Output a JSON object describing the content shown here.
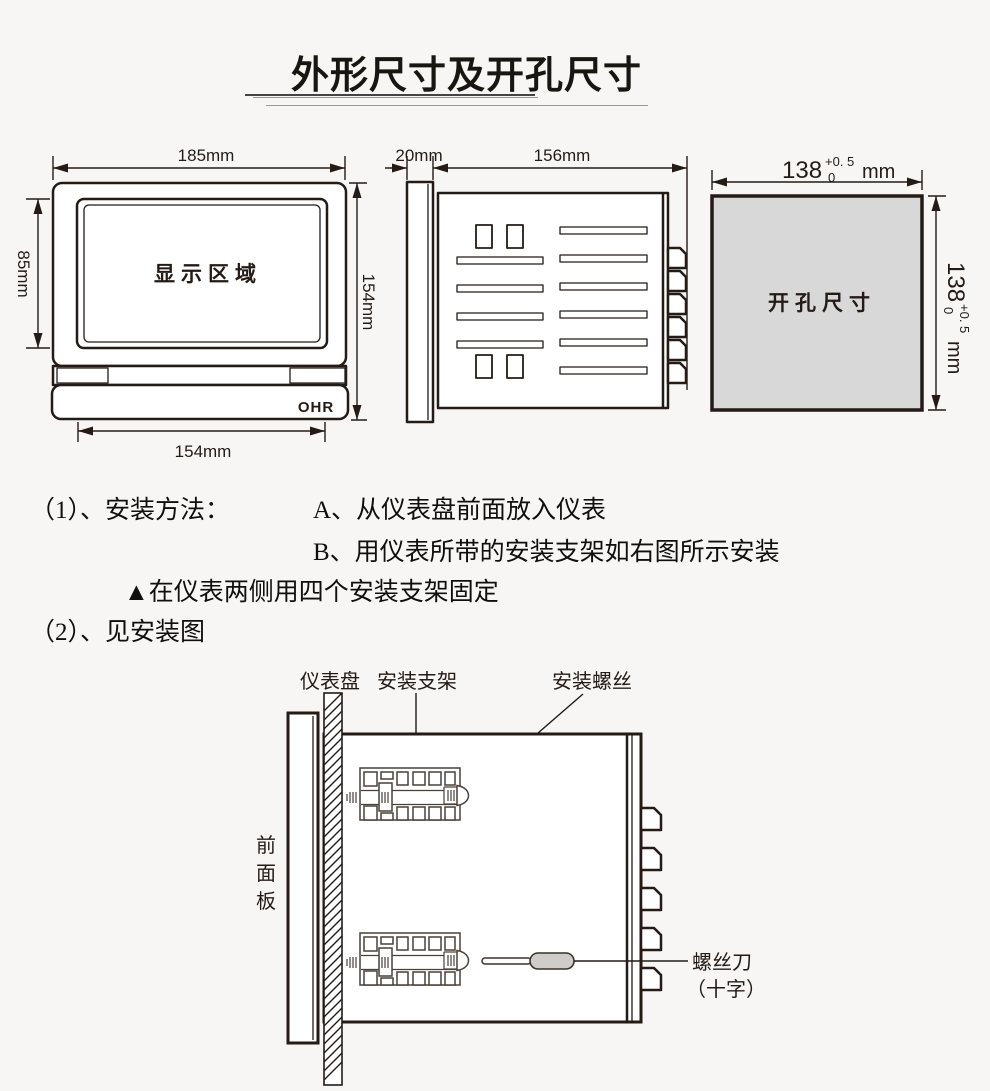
{
  "title": "外形尺寸及开孔尺寸",
  "front_view": {
    "display_area_label": "显示区域",
    "brand_logo": "OHR",
    "dim_top": "185mm",
    "dim_left": "85mm",
    "dim_right": "154mm",
    "dim_bottom": "154mm"
  },
  "side_view": {
    "dim_front_depth": "20mm",
    "dim_body_depth": "156mm"
  },
  "cutout_view": {
    "label": "开孔尺寸",
    "width_dim": {
      "value": "138",
      "tol_plus": "+0. 5",
      "tol_minus": "0",
      "unit": "mm"
    },
    "height_dim": {
      "value": "138",
      "tol_plus": "+0. 5",
      "tol_minus": "0",
      "unit": "mm"
    }
  },
  "instructions": {
    "item1_label": "（1）、安装方法：",
    "step_a": "A、从仪表盘前面放入仪表",
    "step_b": "B、用仪表所带的安装支架如右图所示安装",
    "note": "▲在仪表两侧用四个安装支架固定",
    "item2_label": "（2）、见安装图"
  },
  "install_diagram": {
    "panel_label": "仪表盘",
    "bracket_label": "安装支架",
    "screw_label": "安装螺丝",
    "front_panel_chars": [
      "前",
      "面",
      "板"
    ],
    "screwdriver_label": "螺丝刀",
    "screwdriver_type": "（十字）"
  },
  "colors": {
    "ink": "#241b16",
    "cutout_fill": "#d8d8d8",
    "handle_fill": "#cfcdc9",
    "background": "#f7f6f4"
  }
}
